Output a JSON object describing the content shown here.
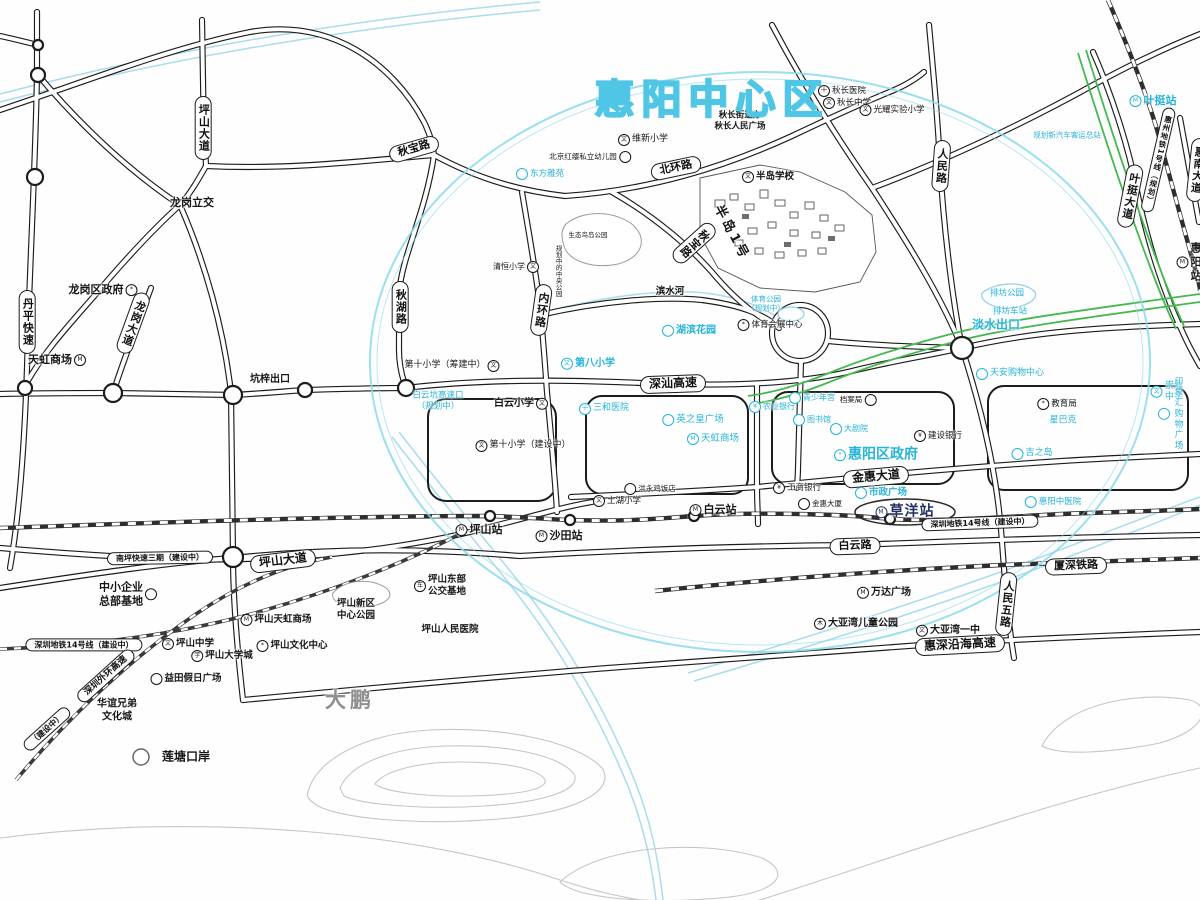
{
  "map": {
    "title": "惠阳中心区",
    "annotations": [
      {
        "k": "p",
        "n": "pill-pingshan-dadao-n",
        "t": "坪山大道",
        "x": 203,
        "y": 128,
        "v": 1
      },
      {
        "k": "p",
        "n": "pill-qiubao-lu",
        "t": "秋宝路",
        "x": 414,
        "y": 149,
        "rot": -16
      },
      {
        "k": "p",
        "n": "pill-qiuhu-lu",
        "t": "秋湖路",
        "x": 400,
        "y": 307,
        "v": 1
      },
      {
        "k": "p",
        "n": "pill-neihuan-lu",
        "t": "内环路",
        "x": 541,
        "y": 310,
        "v": 1,
        "rot": 8
      },
      {
        "k": "p",
        "n": "pill-beihuan-lu",
        "t": "北环路",
        "x": 676,
        "y": 168,
        "rot": -12
      },
      {
        "k": "p",
        "n": "pill-qiubao-lu-2",
        "t": "秋宝路",
        "x": 694,
        "y": 243,
        "v": 1,
        "rot": 48
      },
      {
        "k": "p",
        "n": "pill-renmin-lu",
        "t": "人民路",
        "x": 941,
        "y": 166,
        "v": 1,
        "rot": 4
      },
      {
        "k": "p",
        "n": "pill-yeting-dadao",
        "t": "叶挺大道",
        "x": 1130,
        "y": 196,
        "v": 1,
        "rot": 11
      },
      {
        "k": "p",
        "n": "pill-huizhou-metro1",
        "t": "惠州地铁1号线（规划）",
        "x": 1158,
        "y": 160,
        "v": 1,
        "rot": 13,
        "fs": 7.5
      },
      {
        "k": "p",
        "n": "pill-huinan-dadao",
        "t": "惠南大道",
        "x": 1197,
        "y": 170,
        "v": 1,
        "rot": 6
      },
      {
        "k": "p",
        "n": "pill-shenshan-gaosu",
        "t": "深汕高速",
        "x": 673,
        "y": 384,
        "rot": -2,
        "fs": 12
      },
      {
        "k": "p",
        "n": "pill-jinhui-dadao",
        "t": "金惠大道",
        "x": 876,
        "y": 477,
        "rot": -5,
        "fs": 12
      },
      {
        "k": "p",
        "n": "pill-baiyun-lu",
        "t": "白云路",
        "x": 855,
        "y": 546,
        "rot": -2
      },
      {
        "k": "p",
        "n": "pill-pingshan-dadao-s",
        "t": "坪山大道",
        "x": 283,
        "y": 561,
        "rot": -7,
        "fs": 12
      },
      {
        "k": "p",
        "n": "pill-nanping-exp3",
        "t": "南坪快速三期（建设中）",
        "x": 160,
        "y": 558,
        "rot": -1,
        "fs": 8
      },
      {
        "k": "p",
        "n": "pill-sz-metro14-w",
        "t": "深圳地铁14号线（建设中）",
        "x": 84,
        "y": 645,
        "fs": 8
      },
      {
        "k": "p",
        "n": "pill-sz-metro14-e",
        "t": "深圳地铁14号线（建设中）",
        "x": 980,
        "y": 523,
        "rot": -2,
        "fs": 8
      },
      {
        "k": "p",
        "n": "pill-xiashen-railway",
        "t": "厦深铁路",
        "x": 1076,
        "y": 566,
        "rot": -2
      },
      {
        "k": "p",
        "n": "pill-renmin-5-lu",
        "t": "人民五路",
        "x": 1006,
        "y": 604,
        "v": 1,
        "rot": 6
      },
      {
        "k": "p",
        "n": "pill-huishen-coastal",
        "t": "惠深沿海高速",
        "x": 960,
        "y": 645,
        "rot": -3,
        "fs": 12
      },
      {
        "k": "p",
        "n": "pill-longgang-dadao",
        "t": "龙岗大道",
        "x": 133,
        "y": 323,
        "v": 1,
        "rot": 20
      },
      {
        "k": "p",
        "n": "pill-danping-express",
        "t": "丹平快速",
        "x": 27,
        "y": 322,
        "v": 1
      },
      {
        "k": "p",
        "n": "pill-outer-ring",
        "t": "深圳外环高速",
        "x": 106,
        "y": 676,
        "rot": -42,
        "fs": 9
      },
      {
        "k": "p",
        "n": "pill-outer-ring-status",
        "t": "（建设中）",
        "x": 47,
        "y": 729,
        "rot": -42,
        "fs": 8
      },
      {
        "k": "s",
        "n": "yeting-station",
        "t": "叶挺站",
        "x": 1153,
        "y": 101,
        "c": "b",
        "i": "metro-icon"
      },
      {
        "k": "s",
        "n": "huiyang-station",
        "t": "惠阳站",
        "x": 1189,
        "y": 262,
        "i": "metro-icon"
      },
      {
        "k": "s",
        "n": "pingshan-station",
        "t": "坪山站",
        "x": 479,
        "y": 530,
        "i": "rail-icon"
      },
      {
        "k": "s",
        "n": "shatian-station",
        "t": "沙田站",
        "x": 559,
        "y": 536,
        "i": "metro-icon"
      },
      {
        "k": "s",
        "n": "baiyun-station",
        "t": "白云站",
        "x": 713,
        "y": 510,
        "i": "metro-icon"
      },
      {
        "k": "s",
        "n": "caoyang-station",
        "t": "草洋站",
        "x": 905,
        "y": 512,
        "i": "metro-icon",
        "fs": 14,
        "cls2": "hl"
      },
      {
        "k": "l",
        "n": "longgang-interchange",
        "t": "龙岗立交",
        "x": 192,
        "y": 203,
        "fs": 11,
        "b": 1
      },
      {
        "k": "l",
        "n": "longgang-gov",
        "t": "龙岗区政府",
        "x": 103,
        "y": 290,
        "fs": 11,
        "b": 1,
        "i": "gov-icon",
        "ip": "r"
      },
      {
        "k": "l",
        "n": "tianhong-mall-west",
        "t": "天虹商场",
        "x": 57,
        "y": 360,
        "fs": 11,
        "b": 1,
        "i": "shop-icon",
        "ip": "r"
      },
      {
        "k": "l",
        "n": "kengzi-exit",
        "t": "坑梓出口",
        "x": 270,
        "y": 380,
        "fs": 10,
        "b": 1
      },
      {
        "k": "l",
        "n": "qiuchang-subdistrict",
        "t": "秋长街道办\n秋长人民广场",
        "x": 740,
        "y": 121,
        "fs": 8.5,
        "b": 1
      },
      {
        "k": "l",
        "n": "qiuchang-hospital",
        "t": "秋长医院",
        "x": 842,
        "y": 91,
        "fs": 8.5,
        "i": "hospital-icon"
      },
      {
        "k": "l",
        "n": "qiuchang-middle-school",
        "t": "秋长中学",
        "x": 847,
        "y": 103,
        "fs": 8.5,
        "i": "school-icon"
      },
      {
        "k": "l",
        "n": "guangyao-primary",
        "t": "光耀实验小学",
        "x": 892,
        "y": 110,
        "fs": 8.5,
        "i": "school-icon"
      },
      {
        "k": "l",
        "n": "weixin-primary",
        "t": "维新小学",
        "x": 643,
        "y": 140,
        "fs": 9,
        "i": "school-icon"
      },
      {
        "k": "l",
        "n": "hongying-kindergarten",
        "t": "北京红缨私立幼儿园",
        "x": 590,
        "y": 157,
        "fs": 7.5,
        "i": "dot-icon",
        "ip": "r"
      },
      {
        "k": "l",
        "n": "dongfang-yayuan",
        "t": "东方雅苑",
        "x": 540,
        "y": 174,
        "c": "b",
        "fs": 8.5,
        "i": "dot-icon"
      },
      {
        "k": "l",
        "n": "bandao-school",
        "t": "半岛学校",
        "x": 768,
        "y": 177,
        "fs": 9.5,
        "b": 1,
        "i": "school-icon"
      },
      {
        "k": "l",
        "n": "bandao-no1",
        "t": "半岛1号",
        "x": 731,
        "y": 233,
        "fs": 13,
        "b": 1,
        "rot": 62,
        "ls": 3
      },
      {
        "k": "l",
        "n": "qingheng-primary",
        "t": "清恒小学",
        "x": 516,
        "y": 267,
        "fs": 8,
        "i": "school-icon",
        "ip": "r"
      },
      {
        "k": "l",
        "n": "bird-island-note",
        "t": "生态鸟岛公园",
        "x": 588,
        "y": 235,
        "fs": 6.5
      },
      {
        "k": "l",
        "n": "central-park-note",
        "t": "规划中的中央公园",
        "x": 558,
        "y": 271,
        "fs": 6.5,
        "v": 1
      },
      {
        "k": "l",
        "n": "binshui-river",
        "t": "滨水河",
        "x": 670,
        "y": 292,
        "fs": 9.5,
        "b": 1
      },
      {
        "k": "l",
        "n": "hubin-garden",
        "t": "湖滨花园",
        "x": 689,
        "y": 331,
        "c": "b",
        "fs": 10,
        "b": 1,
        "i": "dot-icon"
      },
      {
        "k": "l",
        "n": "sports-park-plan",
        "t": "体育公园\n（规划中）",
        "x": 766,
        "y": 304,
        "c": "b",
        "fs": 7.5
      },
      {
        "k": "l",
        "n": "sports-expo-center",
        "t": "体育会展中心",
        "x": 770,
        "y": 325,
        "fs": 8.5,
        "i": "gov-icon"
      },
      {
        "k": "l",
        "n": "paifang-park",
        "t": "排坊公园",
        "x": 1007,
        "y": 294,
        "c": "b",
        "fs": 8.5
      },
      {
        "k": "l",
        "n": "paifang-stop",
        "t": "排坊车站",
        "x": 1010,
        "y": 312,
        "c": "b",
        "fs": 8.5
      },
      {
        "k": "l",
        "n": "danshui-exit",
        "t": "淡水出口",
        "x": 996,
        "y": 325,
        "c": "b",
        "fs": 12,
        "b": 1
      },
      {
        "k": "l",
        "n": "no8-primary",
        "t": "第八小学",
        "x": 588,
        "y": 364,
        "c": "b",
        "fs": 10,
        "b": 1,
        "i": "school-icon"
      },
      {
        "k": "l",
        "n": "no10-primary-a",
        "t": "第十小学（筹建中）",
        "x": 452,
        "y": 366,
        "fs": 9,
        "i": "school-icon",
        "ip": "r"
      },
      {
        "k": "l",
        "n": "baiyun-primary",
        "t": "白云小学",
        "x": 521,
        "y": 404,
        "fs": 10,
        "b": 1,
        "i": "school-icon",
        "ip": "r"
      },
      {
        "k": "l",
        "n": "baiyunkeng-exit",
        "t": "白云坑高速口\n（规划中）",
        "x": 438,
        "y": 401,
        "c": "b",
        "fs": 8.5
      },
      {
        "k": "l",
        "n": "no10-primary-b",
        "t": "第十小学（建设中）",
        "x": 523,
        "y": 446,
        "fs": 9,
        "i": "school-icon"
      },
      {
        "k": "l",
        "n": "sanhe-hospital",
        "t": "三和医院",
        "x": 604,
        "y": 409,
        "c": "b",
        "fs": 9,
        "i": "hospital-icon"
      },
      {
        "k": "l",
        "n": "yingzhihuang-plaza",
        "t": "英之皇广场",
        "x": 693,
        "y": 420,
        "c": "b",
        "fs": 9.5,
        "i": "dot-icon"
      },
      {
        "k": "l",
        "n": "tianhong-mall-center",
        "t": "天虹商场",
        "x": 713,
        "y": 439,
        "c": "b",
        "fs": 9.5,
        "i": "shop-icon"
      },
      {
        "k": "l",
        "n": "nongye-bank",
        "t": "农业银行",
        "x": 772,
        "y": 407,
        "c": "b",
        "fs": 8,
        "i": "bank-icon"
      },
      {
        "k": "l",
        "n": "qingshaonian-gong",
        "t": "青少年宫",
        "x": 812,
        "y": 398,
        "c": "b",
        "fs": 8,
        "i": "dot-icon"
      },
      {
        "k": "l",
        "n": "danganju",
        "t": "档案局",
        "x": 858,
        "y": 400,
        "fs": 7.5,
        "i": "dot-icon",
        "ip": "r"
      },
      {
        "k": "l",
        "n": "tushuguan",
        "t": "图书馆",
        "x": 812,
        "y": 420,
        "c": "b",
        "fs": 8,
        "i": "dot-icon"
      },
      {
        "k": "l",
        "n": "dajuyuan",
        "t": "大剧院",
        "x": 849,
        "y": 429,
        "c": "b",
        "fs": 8,
        "i": "dot-icon"
      },
      {
        "k": "l",
        "n": "jianshe-bank",
        "t": "建设银行",
        "x": 938,
        "y": 436,
        "fs": 8.5,
        "i": "bank-icon"
      },
      {
        "k": "l",
        "n": "huiyang-gov",
        "t": "惠阳区政府",
        "x": 876,
        "y": 455,
        "c": "b",
        "fs": 14,
        "b": 1,
        "i": "gov-icon"
      },
      {
        "k": "l",
        "n": "tianan-shopping",
        "t": "天安购物中心",
        "x": 1010,
        "y": 374,
        "c": "b",
        "fs": 9,
        "i": "dot-icon"
      },
      {
        "k": "l",
        "n": "edu-bureau",
        "t": "教育局",
        "x": 1057,
        "y": 404,
        "fs": 8.5,
        "i": "gov-icon"
      },
      {
        "k": "l",
        "n": "starbucks",
        "t": "星巴克",
        "x": 1063,
        "y": 421,
        "c": "b",
        "fs": 9
      },
      {
        "k": "l",
        "n": "chongya-middle",
        "t": "崇雅中学",
        "x": 1167,
        "y": 392,
        "c": "b",
        "fs": 9,
        "i": "school-icon"
      },
      {
        "k": "l",
        "n": "yinxianghui-plaza",
        "t": "印象汇购物广场",
        "x": 1172,
        "y": 414,
        "c": "b",
        "fs": 8.5,
        "i": "dot-icon"
      },
      {
        "k": "l",
        "n": "jizhidao",
        "t": "吉之岛",
        "x": 1032,
        "y": 454,
        "c": "b",
        "fs": 9,
        "i": "dot-icon"
      },
      {
        "k": "l",
        "n": "huiyang-tcm-hospital",
        "t": "惠阳中医院",
        "x": 1053,
        "y": 502,
        "c": "b",
        "fs": 8.5,
        "i": "dot-icon"
      },
      {
        "k": "l",
        "n": "gongshang-bank",
        "t": "工商银行",
        "x": 797,
        "y": 488,
        "fs": 8.5,
        "i": "bank-icon"
      },
      {
        "k": "l",
        "n": "jinhui-building",
        "t": "金惠大厦",
        "x": 820,
        "y": 504,
        "fs": 7.5,
        "i": "dot-icon"
      },
      {
        "k": "l",
        "n": "shizheng-plaza",
        "t": "市政广场",
        "x": 881,
        "y": 493,
        "c": "b",
        "fs": 9.5,
        "b": 1,
        "i": "dot-icon"
      },
      {
        "k": "l",
        "n": "hongyong-restaurant",
        "t": "洪永鸡饭店",
        "x": 650,
        "y": 489,
        "fs": 7.5,
        "i": "dot-icon"
      },
      {
        "k": "l",
        "n": "tuhu-primary",
        "t": "土湖小学",
        "x": 617,
        "y": 501,
        "fs": 8.5,
        "i": "school-icon"
      },
      {
        "k": "l",
        "n": "new-bus-terminal-note",
        "t": "规划新汽车客运总站",
        "x": 1067,
        "y": 135,
        "c": "b",
        "fs": 7.5
      },
      {
        "k": "l",
        "n": "sme-hq-base",
        "t": "中小企业\n总部基地",
        "x": 128,
        "y": 594,
        "fs": 11,
        "b": 1,
        "i": "dot-icon",
        "ip": "r"
      },
      {
        "k": "l",
        "n": "ps-east-bus-base",
        "t": "坪山东部\n公交基地",
        "x": 440,
        "y": 586,
        "fs": 9.5,
        "b": 1,
        "i": "bus-icon"
      },
      {
        "k": "l",
        "n": "ps-center-park",
        "t": "坪山新区\n中心公园",
        "x": 356,
        "y": 610,
        "fs": 9.5,
        "b": 1
      },
      {
        "k": "l",
        "n": "ps-people-hospital",
        "t": "坪山人民医院",
        "x": 450,
        "y": 630,
        "fs": 9.5,
        "b": 1
      },
      {
        "k": "l",
        "n": "ps-tianhong-mall",
        "t": "坪山天虹商场",
        "x": 276,
        "y": 620,
        "fs": 9.5,
        "b": 1,
        "i": "shop-icon"
      },
      {
        "k": "l",
        "n": "ps-middle-school",
        "t": "坪山中学",
        "x": 188,
        "y": 644,
        "fs": 9.5,
        "b": 1,
        "i": "school-icon"
      },
      {
        "k": "l",
        "n": "ps-university-town",
        "t": "坪山大学城",
        "x": 222,
        "y": 656,
        "fs": 9.5,
        "b": 1,
        "i": "edu-icon"
      },
      {
        "k": "l",
        "n": "ps-culture-center",
        "t": "坪山文化中心",
        "x": 292,
        "y": 646,
        "fs": 9.5,
        "b": 1,
        "i": "gov-icon"
      },
      {
        "k": "l",
        "n": "yitian-holiday-plaza",
        "t": "益田假日广场",
        "x": 186,
        "y": 679,
        "fs": 9.5,
        "b": 1,
        "i": "dot-icon"
      },
      {
        "k": "l",
        "n": "huayi-brothers",
        "t": "华谊兄弟\n文化城",
        "x": 117,
        "y": 711,
        "fs": 10,
        "b": 1
      },
      {
        "k": "l",
        "n": "liantang-port",
        "t": "莲塘口岸",
        "x": 186,
        "y": 757,
        "fs": 12,
        "b": 1
      },
      {
        "k": "l",
        "n": "dapeng-region",
        "t": "大鹏",
        "x": 350,
        "y": 700,
        "c": "g",
        "fs": 21,
        "b": 1,
        "ls": 4
      },
      {
        "k": "l",
        "n": "wanda-plaza",
        "t": "万达广场",
        "x": 884,
        "y": 593,
        "fs": 10,
        "b": 1,
        "i": "shop-icon"
      },
      {
        "k": "l",
        "n": "dyw-children-park",
        "t": "大亚湾儿童公园",
        "x": 856,
        "y": 624,
        "fs": 10,
        "b": 1,
        "i": "park-icon"
      },
      {
        "k": "l",
        "n": "dyw-no1-middle",
        "t": "大亚湾一中",
        "x": 948,
        "y": 631,
        "fs": 10,
        "b": 1,
        "i": "school-icon"
      }
    ]
  },
  "icon_glyphs": {
    "school-icon": "文",
    "hospital-icon": "十",
    "bank-icon": "¥",
    "gov-icon": "*",
    "shop-icon": "M",
    "metro-icon": "M",
    "rail-icon": "M",
    "bus-icon": "车",
    "edu-icon": "学",
    "park-icon": "木",
    "dot-icon": ""
  }
}
